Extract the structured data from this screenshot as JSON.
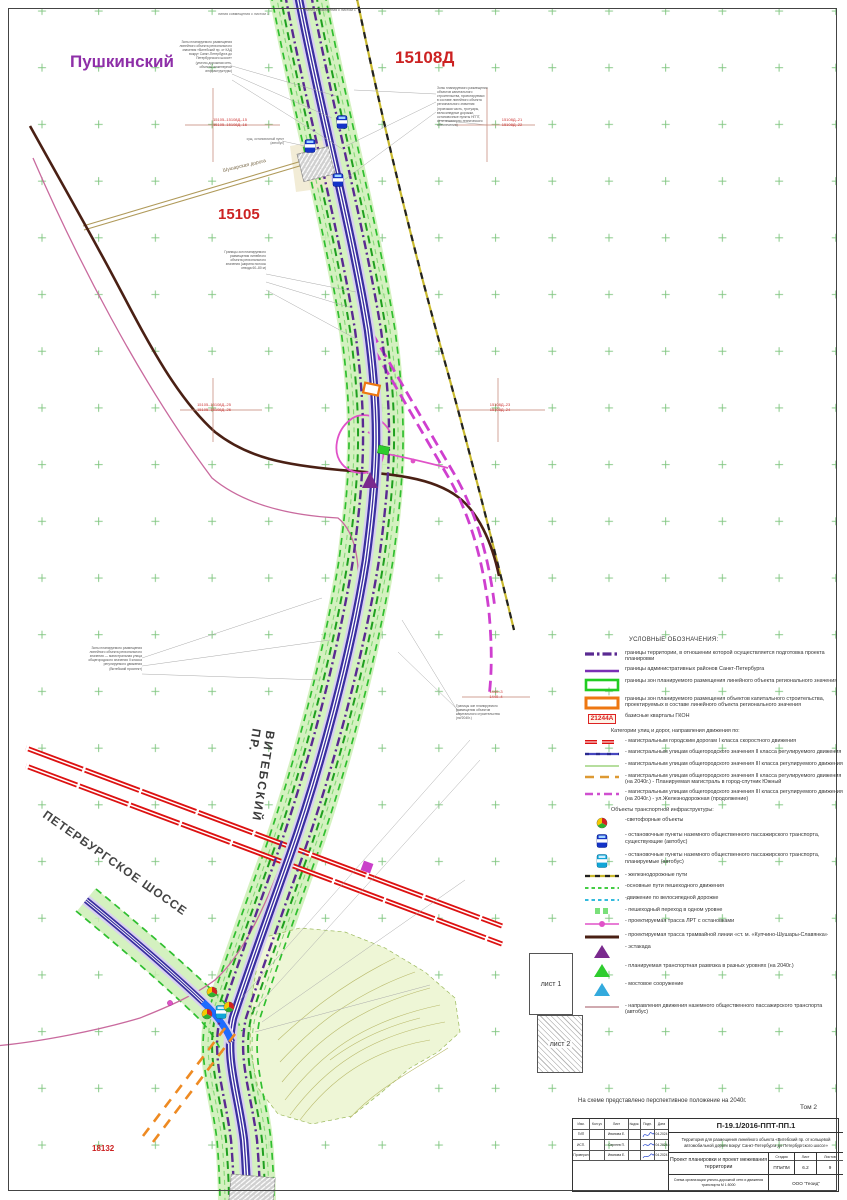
{
  "map": {
    "labels": {
      "district": "Пушкинский",
      "quarter_right": "15108Д",
      "quarter_left": "15105",
      "quarter_bottom": "18132",
      "shushary_road": "Шушарская дорога",
      "vitebsky": "ВИТЕБСКИЙ ПР.",
      "petersburg_highway": "ПЕТЕРБУРГСКОЕ ШОССЕ",
      "sheet1": "лист 1",
      "sheet2": "лист 2",
      "top_note_1": "линия совмещения с листом 1",
      "top_note_2": "линия совмещения с листом 1",
      "bus_note": "сущ. остановочный пункт (автобус)"
    },
    "crosshair_codes": [
      {
        "line1": "15105–15108Д–15",
        "line2": "15105–15108Д–16"
      },
      {
        "line1": "15108Д–21",
        "line2": "15108Д–22"
      },
      {
        "line1": "15105–15108Д–25",
        "line2": "15105–15108Д–26"
      },
      {
        "line1": "15108Д–23",
        "line2": "15108Д–24"
      },
      {
        "line1": "1440–3",
        "line2": "1440–4"
      }
    ],
    "annotations": [
      {
        "text": "Зоны планируемого размещения\nлинейного объекта регионального\nзначения «Витебский пр. от КАД\nвокруг Санкт-Петербурга до\nПетербургского шоссе»\n(улично-дорожная сеть,\nобъекты инженерной\nинфраструктуры)"
      },
      {
        "text": "Зоны планируемого размещения\nобъектов капитального\nстроительства, проектируемых\nв составе линейного объекта\nрегионального значения\n(проезжая часть, тротуары,\nвелосипедные дорожки,\nостановочные пункты НГПТ,\nсети инженерно-технического\nобеспечения)"
      },
      {
        "text": "Границы зон планируемого\nразмещения линейного\nобъекта регионального\nзначения (ширина полосы\nотвода 60–80 м)"
      },
      {
        "text": "Зоны планируемого размещения\nлинейного объекта регионального\nзначения — магистральная улица\nобщегородского значения II класса\nрегулируемого движения\n(Витебский проспект)"
      },
      {
        "text": "Границы зон планируемого\nразмещения объектов\nкапитального строительства\n(на 2040г.)"
      }
    ]
  },
  "legend": {
    "title": "УСЛОВНЫЕ ОБОЗНАЧЕНИЯ:",
    "boundary_items": [
      {
        "text": "границы территории, в отношении которой осуществляется подготовка проекта планировки"
      },
      {
        "text": "границы административных районов Санкт-Петербурга"
      },
      {
        "text": "границы зон планируемого размещения линейного объекта регионального значения"
      },
      {
        "text": "границы зон планируемого размещения объектов капитального строительства, проектируемых в составе линейного объекта регионального значения"
      },
      {
        "text": "базисные кварталы ГКОН"
      }
    ],
    "quarter_sample": "21244А",
    "cat_header": "Категории улиц и дорог, направления движения по:",
    "cat_items": [
      {
        "text": "- магистральным городским дорогам I класса скоростного движения"
      },
      {
        "text": "- магистральным улицам общегородского значения II класса регулируемого движения"
      },
      {
        "text": "- магистральным улицам общегородского значения III класса регулируемого движения"
      },
      {
        "text": "- магистральным улицам общегородского значения II класса регулируемого движения (на 2040г.) - Планируемая магистраль в город-спутник Южный"
      },
      {
        "text": "- магистральным улицам общегородского значения III класса регулируемого движения (на 2040г.) - ул.Железнодорожная (продолжение)"
      }
    ],
    "obj_header": "Объекты транспортной инфраструктуры:",
    "obj_items": [
      {
        "text": "-светофорные объекты"
      },
      {
        "text": "- остановочные пункты наземного общественного пассажирского транспорта, существующие (автобус)"
      },
      {
        "text": "- остановочные пункты наземного общественного пассажирского транспорта, планируемые (автобус)"
      },
      {
        "text": "- железнодорожные пути"
      },
      {
        "text": "-основные пути пешеходного движения"
      },
      {
        "text": "-движение по велосипедной дорожке"
      },
      {
        "text": "- пешеходный переход в одном уровне"
      },
      {
        "text": "- проектируемая трасса ЛРТ с остановками"
      },
      {
        "text": "- проектируемая трасса трамвайной линии «ст. м. «Купчино-Шушары-Славянка»"
      },
      {
        "text": "- эстакада"
      },
      {
        "text": "- планируемая транспортная развязка в разных уровнях (на 2040г.)"
      },
      {
        "text": "- мостовое сооружение"
      },
      {
        "text": "- направления движения наземного общественного пассажирского транспорта (автобус)"
      }
    ]
  },
  "note": "На схеме представлено перспективное положение на 2040г.",
  "tom": "Том 2",
  "title_block": {
    "doc_code": "П-19.1/2016-ППТ-ПП.1",
    "project": "Территория для размещения линейного объекта «Витебский пр. от кольцевой автомобильной дороги вокруг Санкт-Петербурга до Петербургского шоссе»",
    "doc_title": "Проект планировки и проект межевания территории",
    "stage_label": "Стадия",
    "stage": "ППиПМ",
    "sheet_label": "Лист",
    "sheet": "6.2",
    "sheets_label": "Листов",
    "sheets": "9",
    "scheme": "Схема организации улично-дорожной сети и движения транспорта М 1:5000",
    "company": "ООО \"Геоид\"",
    "cols": [
      "Изм.",
      "Кол.уч",
      "Лист",
      "№док.",
      "Подп.",
      "Дата"
    ],
    "staff": [
      {
        "role": "ГИП",
        "name": "Иванова Е.",
        "date": "04.2024"
      },
      {
        "role": "ИСП.",
        "name": "Сергеев П.",
        "date": "04.2024"
      },
      {
        "role": "Проверил",
        "name": "Иванова Е.",
        "date": "04.2024"
      }
    ]
  },
  "colors": {
    "corridor": "#cdeeb5",
    "road_purple": "#3a2fa0",
    "boundary_purple": "#5a2a92",
    "category_I_red": "#dd1111",
    "planned_orange": "#ee8a22",
    "zhd_magenta": "#cf3fcf",
    "lrt_pink": "#e052c8",
    "tram_maroon": "#4a2014",
    "railway_yellow": "#c9b92e",
    "grid_green": "#7cc47c"
  }
}
